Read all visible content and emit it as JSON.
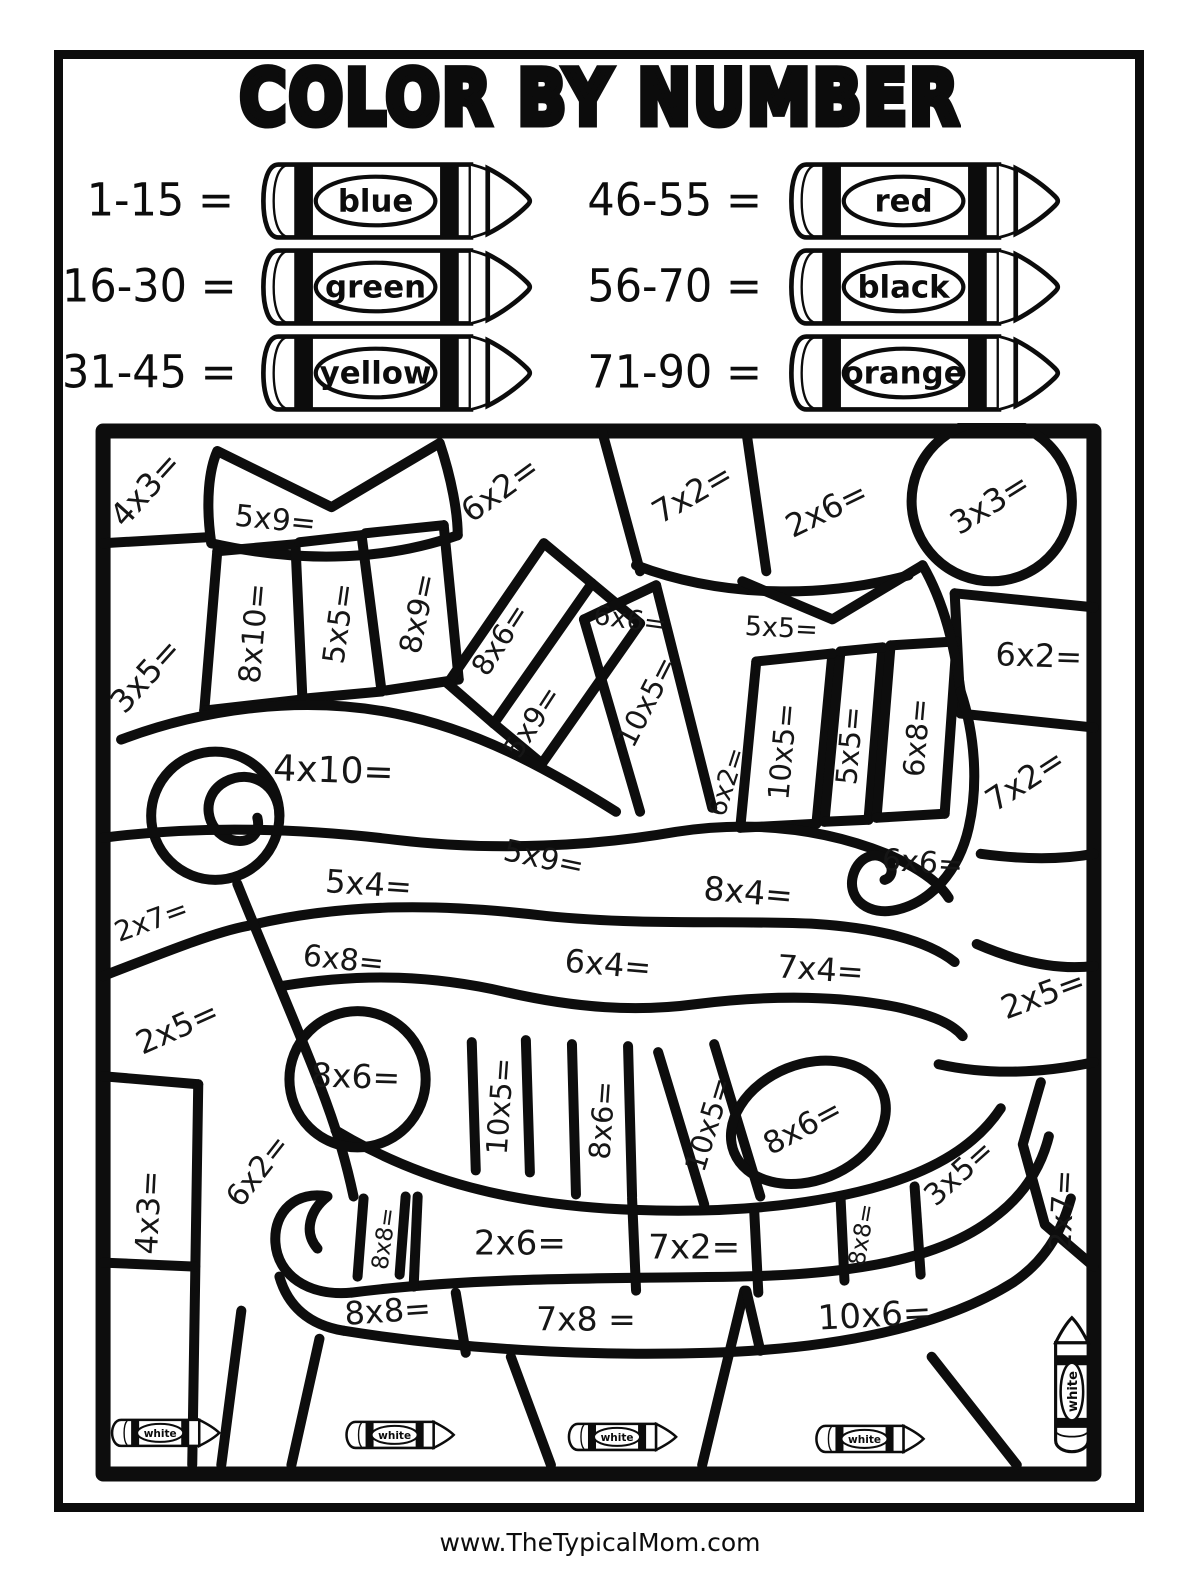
{
  "page": {
    "title": "COLOR BY NUMBER",
    "footer": "www.TheTypicalMom.com"
  },
  "legend": {
    "items": [
      {
        "range": "1-15 =",
        "color": "blue"
      },
      {
        "range": "16-30 =",
        "color": "green"
      },
      {
        "range": "31-45 =",
        "color": "yellow"
      },
      {
        "range": "46-55 =",
        "color": "red"
      },
      {
        "range": "56-70 =",
        "color": "black"
      },
      {
        "range": "71-90 =",
        "color": "orange"
      }
    ]
  },
  "puzzle": {
    "white_label": "white",
    "cells": [
      {
        "label": "4x3=",
        "x": 50,
        "y": 66,
        "r": -48,
        "s": 32
      },
      {
        "label": "5x9=",
        "x": 180,
        "y": 96,
        "r": 6,
        "s": 30
      },
      {
        "label": "6x2=",
        "x": 404,
        "y": 66,
        "r": -36,
        "s": 32
      },
      {
        "label": "7x2=",
        "x": 596,
        "y": 70,
        "r": -30,
        "s": 32
      },
      {
        "label": "2x6=",
        "x": 730,
        "y": 86,
        "r": -26,
        "s": 32
      },
      {
        "label": "3x3=",
        "x": 893,
        "y": 80,
        "r": -32,
        "s": 32
      },
      {
        "label": "3x5=",
        "x": 50,
        "y": 252,
        "r": -48,
        "s": 32
      },
      {
        "label": "8x10=",
        "x": 158,
        "y": 210,
        "r": -85,
        "s": 30
      },
      {
        "label": "5x5=",
        "x": 243,
        "y": 200,
        "r": -82,
        "s": 30
      },
      {
        "label": "8x9=",
        "x": 322,
        "y": 190,
        "r": -78,
        "s": 30
      },
      {
        "label": "8x6=",
        "x": 404,
        "y": 216,
        "r": -57,
        "s": 29
      },
      {
        "label": "5x9=",
        "x": 436,
        "y": 298,
        "r": -57,
        "s": 29
      },
      {
        "label": "6x6=",
        "x": 534,
        "y": 196,
        "r": 8,
        "s": 27
      },
      {
        "label": "5x5=",
        "x": 685,
        "y": 204,
        "r": 3,
        "s": 27
      },
      {
        "label": "10x5=",
        "x": 550,
        "y": 278,
        "r": -63,
        "s": 29
      },
      {
        "label": "6x2=",
        "x": 630,
        "y": 358,
        "r": -72,
        "s": 26
      },
      {
        "label": "10x5=",
        "x": 686,
        "y": 328,
        "r": -85,
        "s": 29
      },
      {
        "label": "5x5=",
        "x": 753,
        "y": 322,
        "r": -85,
        "s": 29
      },
      {
        "label": "6x8=",
        "x": 820,
        "y": 314,
        "r": -85,
        "s": 29
      },
      {
        "label": "6x2=",
        "x": 942,
        "y": 232,
        "r": 2,
        "s": 32
      },
      {
        "label": "7x2=",
        "x": 928,
        "y": 356,
        "r": -33,
        "s": 32
      },
      {
        "label": "4x10=",
        "x": 238,
        "y": 346,
        "r": 2,
        "s": 36
      },
      {
        "label": "5x9=",
        "x": 448,
        "y": 434,
        "r": 12,
        "s": 30
      },
      {
        "label": "2x7=",
        "x": 56,
        "y": 496,
        "r": -20,
        "s": 28
      },
      {
        "label": "5x4=",
        "x": 273,
        "y": 460,
        "r": 4,
        "s": 32
      },
      {
        "label": "6x8=",
        "x": 248,
        "y": 535,
        "r": 6,
        "s": 30
      },
      {
        "label": "6x6=",
        "x": 826,
        "y": 438,
        "r": 4,
        "s": 30
      },
      {
        "label": "8x4=",
        "x": 652,
        "y": 468,
        "r": 5,
        "s": 33
      },
      {
        "label": "6x4=",
        "x": 512,
        "y": 540,
        "r": 5,
        "s": 32
      },
      {
        "label": "7x4=",
        "x": 724,
        "y": 545,
        "r": 4,
        "s": 32
      },
      {
        "label": "2x5=",
        "x": 946,
        "y": 570,
        "r": -20,
        "s": 32
      },
      {
        "label": "2x5=",
        "x": 82,
        "y": 603,
        "r": -24,
        "s": 32
      },
      {
        "label": "8x6=",
        "x": 260,
        "y": 652,
        "r": 2,
        "s": 33
      },
      {
        "label": "10x5=",
        "x": 404,
        "y": 682,
        "r": -86,
        "s": 29
      },
      {
        "label": "8x6=",
        "x": 506,
        "y": 696,
        "r": -86,
        "s": 29
      },
      {
        "label": "10x5=",
        "x": 612,
        "y": 700,
        "r": -73,
        "s": 29
      },
      {
        "label": "8x6=",
        "x": 706,
        "y": 702,
        "r": -28,
        "s": 31
      },
      {
        "label": "3x5=",
        "x": 862,
        "y": 748,
        "r": -42,
        "s": 30
      },
      {
        "label": "4x3=",
        "x": 53,
        "y": 788,
        "r": -87,
        "s": 31
      },
      {
        "label": "6x2=",
        "x": 162,
        "y": 746,
        "r": -52,
        "s": 30
      },
      {
        "label": "8x8=",
        "x": 288,
        "y": 814,
        "r": -82,
        "s": 23
      },
      {
        "label": "2x6=",
        "x": 424,
        "y": 818,
        "r": 0,
        "s": 34
      },
      {
        "label": "7x2=",
        "x": 598,
        "y": 822,
        "r": 0,
        "s": 34
      },
      {
        "label": "8x8=",
        "x": 765,
        "y": 810,
        "r": -80,
        "s": 23
      },
      {
        "label": "2x7=",
        "x": 965,
        "y": 786,
        "r": -87,
        "s": 30
      },
      {
        "label": "8x8=",
        "x": 292,
        "y": 886,
        "r": -4,
        "s": 32
      },
      {
        "label": "7x8 =",
        "x": 490,
        "y": 894,
        "r": 0,
        "s": 33
      },
      {
        "label": "10x6=",
        "x": 778,
        "y": 890,
        "r": -3,
        "s": 34
      }
    ],
    "white_crayons": [
      {
        "x": 72,
        "y": 1008,
        "r": 0,
        "s": 1
      },
      {
        "x": 306,
        "y": 1010,
        "r": 0,
        "s": 1
      },
      {
        "x": 528,
        "y": 1012,
        "r": 0,
        "s": 1
      },
      {
        "x": 775,
        "y": 1014,
        "r": 0,
        "s": 1
      },
      {
        "x": 975,
        "y": 958,
        "r": -90,
        "s": 1.25
      }
    ]
  }
}
